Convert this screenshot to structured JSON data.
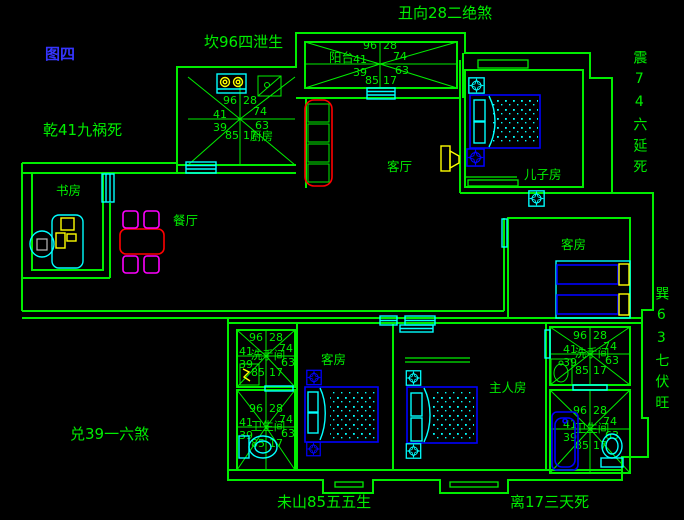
{
  "figure_label": "图四",
  "annotations": {
    "top_center": "丑向28二绝煞",
    "top_kitchen": "坎96四泄生",
    "left_upper": "乾41九祸死",
    "right_upper_vertical": "震74六延死",
    "right_lower_vertical": "巽63七伏旺",
    "left_lower": "兑39一六煞",
    "bottom_center": "未山85五五生",
    "bottom_right": "离17三天死"
  },
  "room_labels": {
    "kitchen": "厨房",
    "balcony": "阳台",
    "living_room": "客厅",
    "son_room": "儿子房",
    "study": "书房",
    "dining": "餐厅",
    "guest_room_right": "客房",
    "guest_room_bottom": "客房",
    "master_room": "主人房",
    "washroom": "洗手间",
    "bathroom": "卫生间"
  },
  "compass_numbers": {
    "top_left": "96",
    "top_right": "28",
    "left_upper": "41",
    "right_upper": "74",
    "left_lower": "39",
    "right_lower": "63",
    "bottom_left": "85",
    "bottom_right": "17"
  },
  "compasses": [
    {
      "id": "kitchen",
      "label_key": "kitchen"
    },
    {
      "id": "balcony",
      "label_key": ""
    },
    {
      "id": "washroom-left",
      "label_key": "washroom"
    },
    {
      "id": "bathroom-left",
      "label_key": "bathroom"
    },
    {
      "id": "washroom-right",
      "label_key": "washroom"
    },
    {
      "id": "bathroom-right",
      "label_key": "bathroom"
    }
  ],
  "colors": {
    "background": "#000000",
    "wall": "#00ee00",
    "text_green": "#00ee00",
    "figure_blue": "#3535ff",
    "fixture_cyan": "#00ffff",
    "furniture_blue": "#0000ff",
    "table_red": "#ff0000",
    "chair_magenta": "#ff00ff",
    "accent_yellow": "#ffff00"
  }
}
